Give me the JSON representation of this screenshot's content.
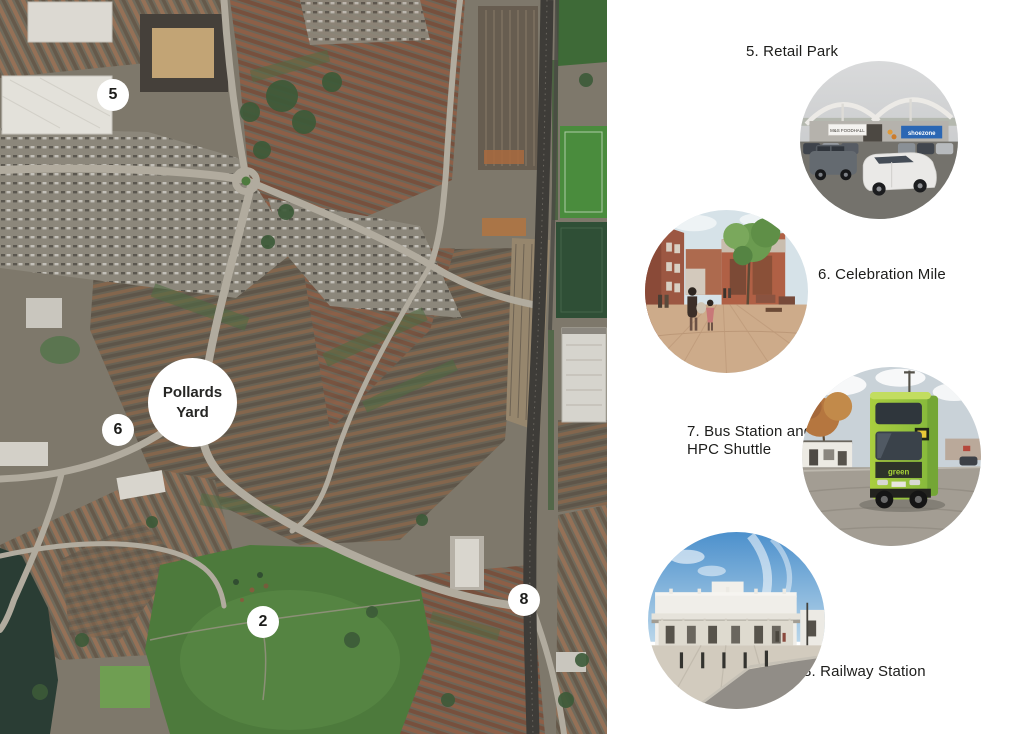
{
  "map": {
    "site_label": {
      "line1": "Pollards",
      "line2": "Yard"
    },
    "markers": {
      "m5": "5",
      "m6": "6",
      "m2": "2",
      "m8": "8"
    }
  },
  "legend": {
    "retail": {
      "label": "5. Retail Park",
      "signs": {
        "foodhall": "M&S FOODHALL",
        "shoezone": "shoezone"
      }
    },
    "celebration": {
      "label": "6. Celebration Mile"
    },
    "bus": {
      "label_line1": "7. Bus Station and",
      "label_line2": "HPC Shuttle",
      "signs": {
        "brand": "green"
      }
    },
    "railway": {
      "label": "8. Railway Station"
    }
  },
  "colors": {
    "background": "#ffffff",
    "label_text": "#1d1d1b",
    "marker_background": "#ffffff",
    "shoezone_blue": "#2b67b4",
    "bus_green": "#9bc53d",
    "park_green": "#4d7a3c"
  }
}
